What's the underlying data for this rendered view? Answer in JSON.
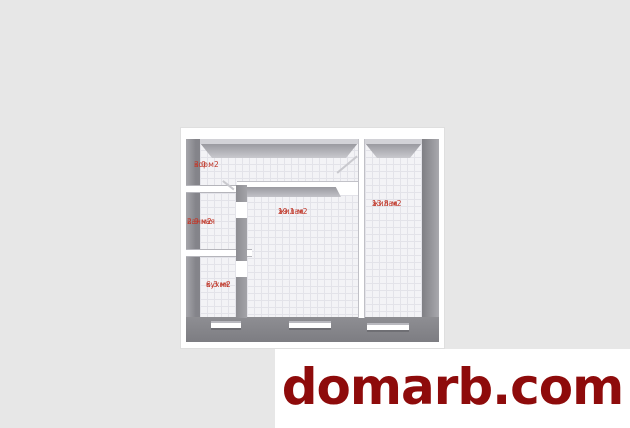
{
  "canvas": {
    "background": "#e7e7e7"
  },
  "floorplan": {
    "type": "apartment-floor-plan-3d",
    "colors": {
      "sheet": "#ffffff",
      "wall_dark": "#85858a",
      "wall_light": "#c9c9ce",
      "floor": "#f3f3f6",
      "grid": "#e3e3e9",
      "label": "#c0392b"
    },
    "rooms": [
      {
        "id": "corridor",
        "label": "кор.",
        "area": "3.0 м2"
      },
      {
        "id": "bathroom",
        "label": "ванная",
        "area": "2.9 м2"
      },
      {
        "id": "living-large",
        "label": "жилая",
        "area": "19.1 м2"
      },
      {
        "id": "living-small",
        "label": "жилая",
        "area": "13.8 м2"
      },
      {
        "id": "kitchen",
        "label": "кухня",
        "area": "6.3 м2"
      }
    ],
    "window_count": 3
  },
  "watermark": {
    "text": "domarb.com",
    "color": "#8e0b0b",
    "background": "#ffffff"
  }
}
